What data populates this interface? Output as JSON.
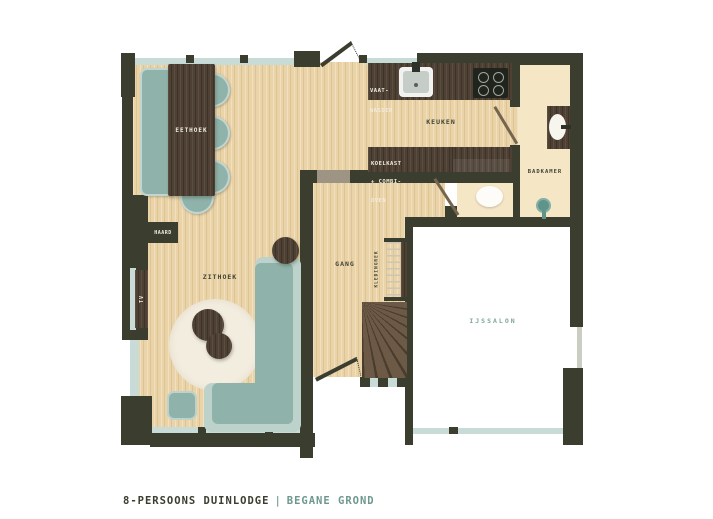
{
  "title_block": {
    "name": "8-PERSOONS DUINLODGE",
    "separator": "|",
    "floor": "BEGANE GROND"
  },
  "rooms": {
    "eethoek": "EETHOEK",
    "keuken": "KEUKEN",
    "badkamer": "BADKAMER",
    "gang": "GANG",
    "zithoek": "ZITHOEK",
    "ijssalon": "IJSSALON"
  },
  "fixtures": {
    "haard": "HAARD",
    "tv": "TV",
    "kledingrek": "KLEDINGREK",
    "vaatwasser_line1": "VAAT-",
    "vaatwasser_line2": "WASSER",
    "koelkast_line1": "KOELKAST",
    "koelkast_line2": "+ COMBI-",
    "koelkast_line3": "OVEN"
  },
  "colors": {
    "wall": "#3B3E2F",
    "wood_floor": "#EAD3A7",
    "dark_wood_furniture": "#4E4134",
    "teal_furniture": "#8FB3AA",
    "teal_furniture_light": "#BCD2CB",
    "window_glass": "#C8DBD7",
    "cream_floor": "#F5E6C6",
    "rug": "#F3EDDF",
    "accent_teal_text": "#7EA59C",
    "dark_text": "#3A3D2F",
    "white_floor": "#FFFFFF"
  }
}
